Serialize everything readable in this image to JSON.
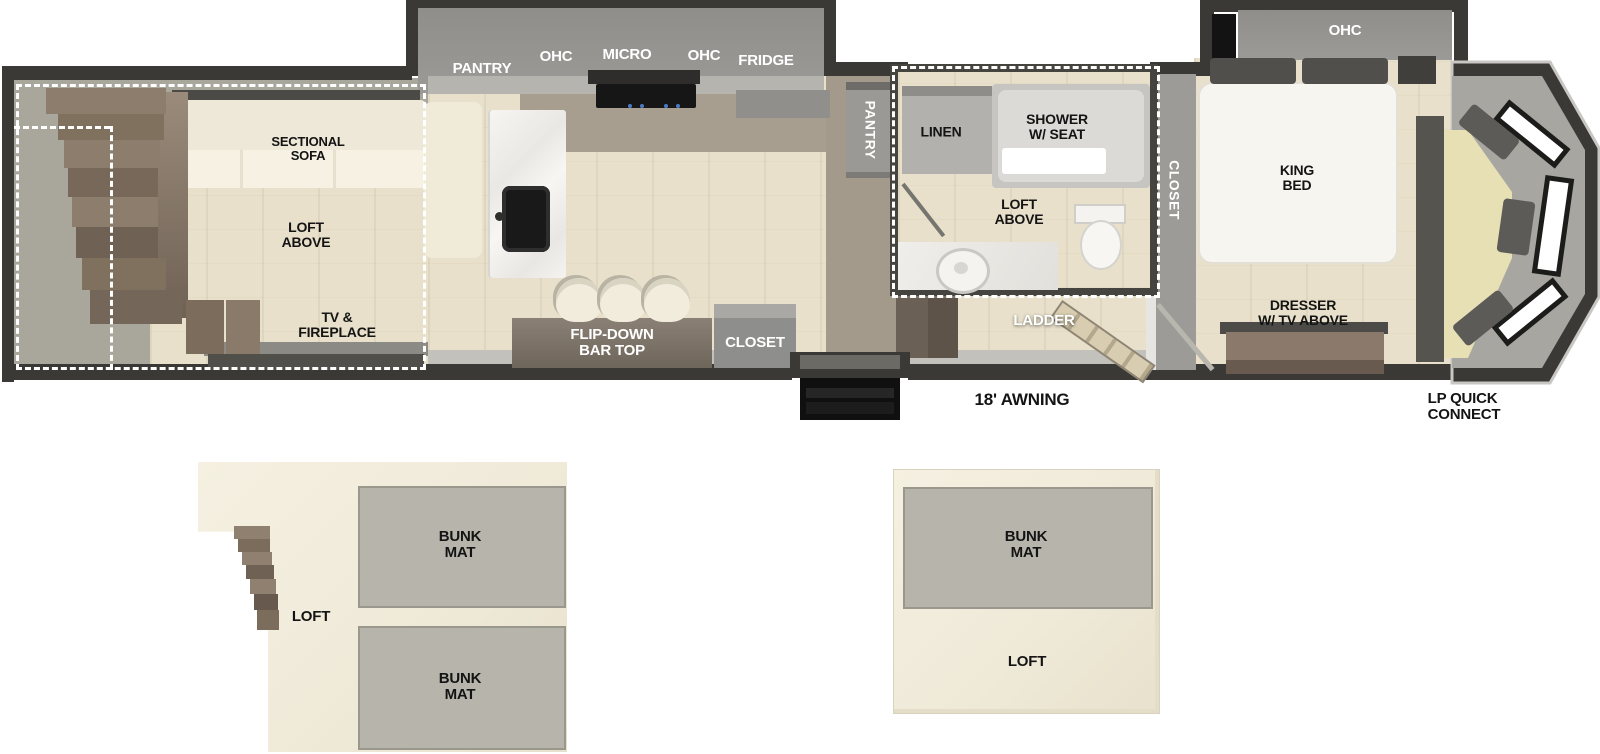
{
  "fp": {
    "rear": {
      "sofa": [
        "SECTIONAL",
        "SOFA"
      ],
      "loft": [
        "LOFT",
        "ABOVE"
      ],
      "tv": [
        "TV &",
        "FIREPLACE"
      ]
    },
    "kitchen": {
      "pantry": "PANTRY",
      "ohc_left": "OHC",
      "micro": "MICRO",
      "ohc_right": "OHC",
      "fridge": "FRIDGE"
    },
    "bar": [
      "FLIP-DOWN",
      "BAR TOP"
    ],
    "closet_mid": "CLOSET",
    "hall_pantry": "PANTRY",
    "bath": {
      "linen": "LINEN",
      "shower": [
        "SHOWER",
        "W/ SEAT"
      ],
      "loft": [
        "LOFT",
        "ABOVE"
      ]
    },
    "ladder": "LADDER",
    "bedroom": {
      "ohc": "OHC",
      "closet": "CLOSET",
      "bed": [
        "KING",
        "BED"
      ],
      "dresser": [
        "DRESSER",
        "W/ TV ABOVE"
      ]
    },
    "exterior": {
      "awning": "18' AWNING",
      "lp": [
        "LP QUICK",
        "CONNECT"
      ]
    }
  },
  "lofts": {
    "left": {
      "label": "LOFT",
      "bunk_top": [
        "BUNK",
        "MAT"
      ],
      "bunk_bottom": [
        "BUNK",
        "MAT"
      ]
    },
    "right": {
      "label": "LOFT",
      "bunk": [
        "BUNK",
        "MAT"
      ]
    }
  },
  "colors": {
    "wall": "#3a3936",
    "floor": "#e8e0ca",
    "slide_gray": "#96958f",
    "khaki": "#e7e0b4"
  }
}
